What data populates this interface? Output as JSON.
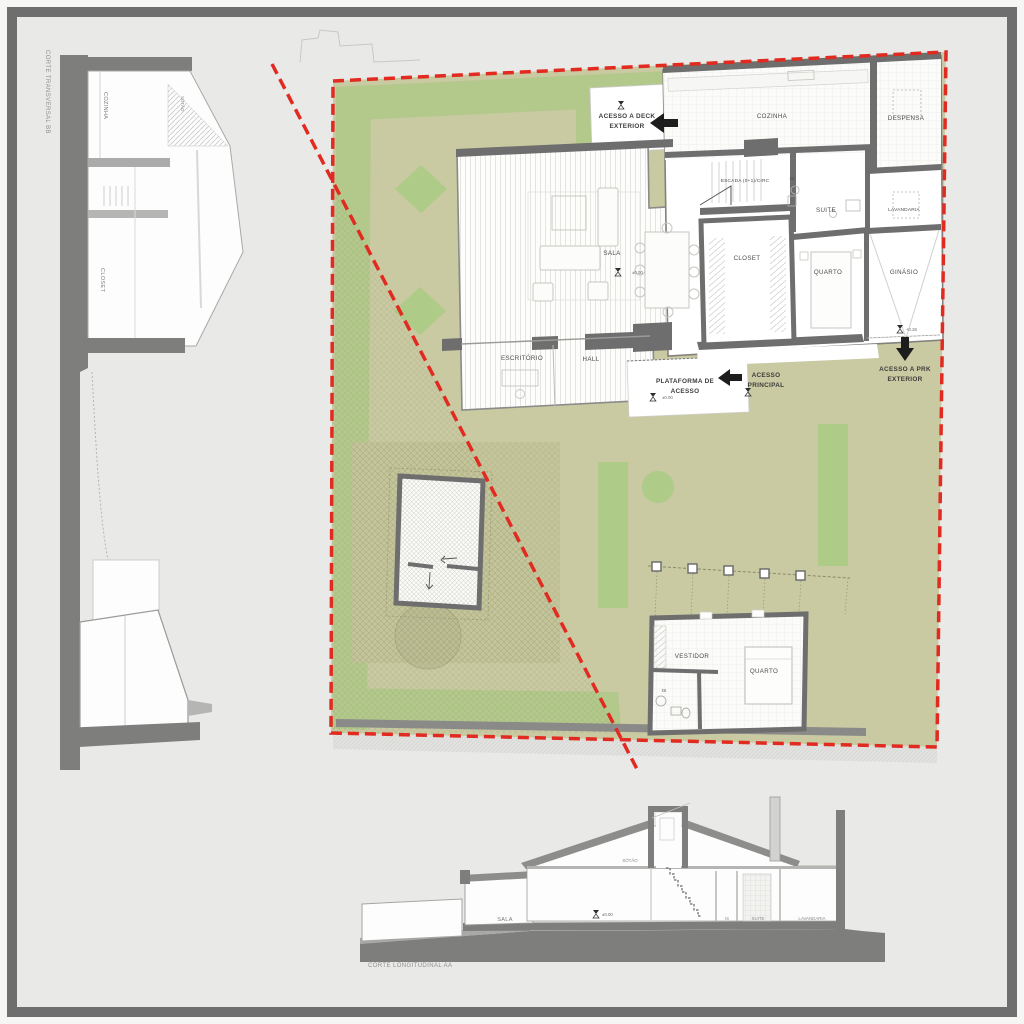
{
  "colors": {
    "frame_gray": "#6e6e6e",
    "canvas_gray": "#e9e9e7",
    "site_olive": "#c9c9a2",
    "garden_green": "#b3c98c",
    "patch_green": "#aecb87",
    "wall_gray": "#6e6e6e",
    "boundary_red": "#e12a20",
    "section_poche": "#7e7e7d"
  },
  "plan": {
    "rooms": {
      "cozinha": "COZINHA",
      "despensa": "DESPENSA",
      "escada": "ESCADA (0+1)/CIRC",
      "is_suite": "IS",
      "suite": "SUITE",
      "lavandaria": "LAVANDARIA",
      "sala": "SALA",
      "closet": "CLOSET",
      "quarto": "QUARTO",
      "ginasio": "GINÁSIO",
      "escritorio": "ESCRITÓRIO",
      "hall": "HALL",
      "vestidor": "VESTIDOR",
      "quarto_anexo": "QUARTO",
      "is_anexo": "IS"
    },
    "annotations": {
      "acesso_deck_l1": "ACESSO A DECK",
      "acesso_deck_l2": "EXTERIOR",
      "plataforma_l1": "PLATAFORMA DE",
      "plataforma_l2": "ACESSO",
      "acesso_principal_l1": "ACESSO",
      "acesso_principal_l2": "PRINCIPAL",
      "acesso_prk_l1": "ACESSO A PRK",
      "acesso_prk_l2": "EXTERIOR",
      "level_sala": "±0.00",
      "level_plataforma": "±0.00",
      "level_prk": "+0.26"
    }
  },
  "sections": {
    "transversal": {
      "title": "CORTE TRANSVERSAL BB",
      "cozinha": "COZINHA",
      "sotao": "SÓTÃO",
      "closet": "CLOSET"
    },
    "longitudinal": {
      "title": "CORTE LONGITUDINAL AA",
      "sala": "SALA",
      "sotao": "SÓTÃO",
      "is": "IS",
      "suite": "SUITE",
      "lavandaria": "LAVANDARIA",
      "level": "±0.00"
    }
  }
}
